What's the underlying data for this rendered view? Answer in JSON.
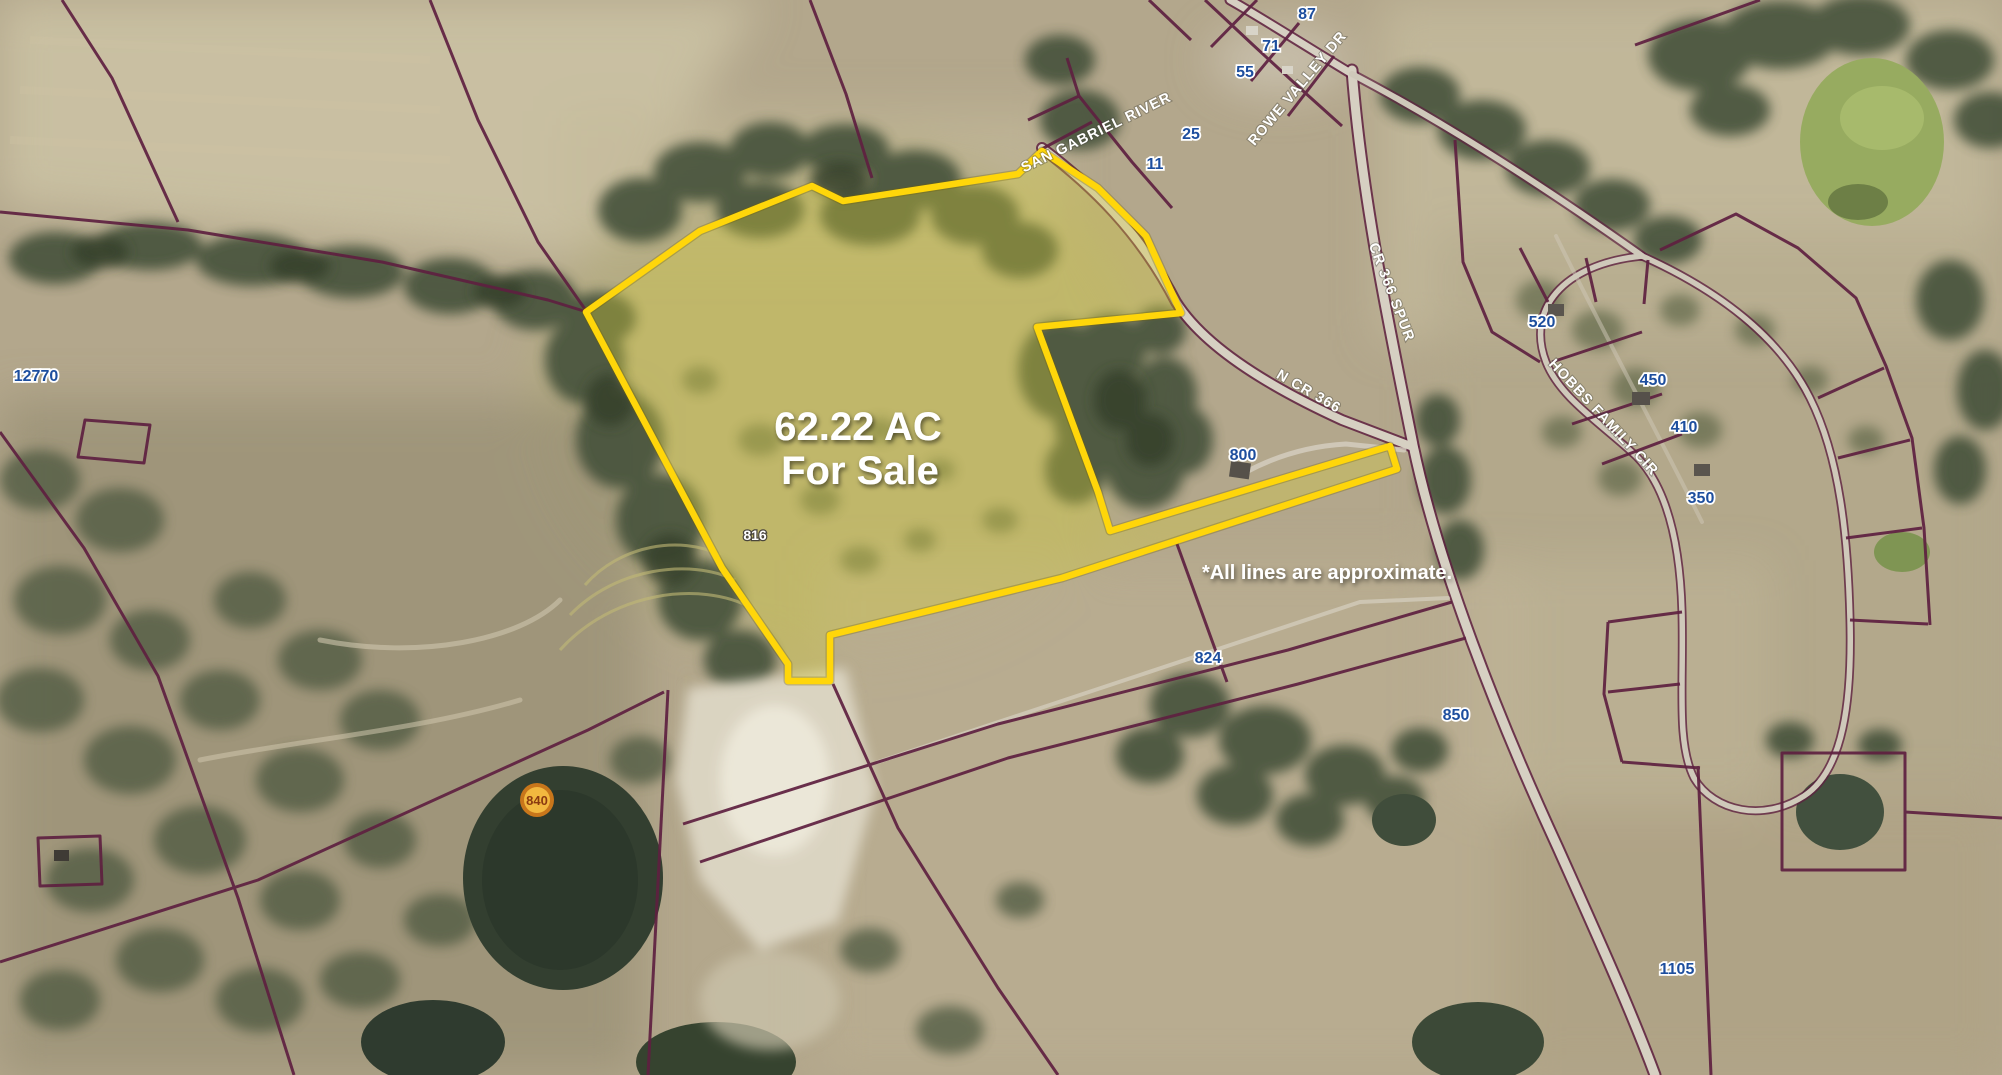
{
  "page": {
    "type": "aerial-property-listing-map"
  },
  "listing": {
    "acreage": "62.22 AC",
    "status": "For Sale",
    "disclaimer": "*All lines are approximate."
  },
  "marker": {
    "value": "840"
  },
  "roads": {
    "san_gabriel_river": "SAN GABRIEL RIVER",
    "rowe_valley_dr": "ROWE VALLEY DR",
    "cr_366_spur": "CR 366 SPUR",
    "n_cr_366": "N CR 366",
    "hobbs_family_cir": "HOBBS FAMILY CIR"
  },
  "addresses": {
    "a87": "87",
    "a71": "71",
    "a55": "55",
    "a25": "25",
    "a11": "11",
    "a12770": "12770",
    "a816": "816",
    "a800": "800",
    "a824": "824",
    "a850": "850",
    "a520": "520",
    "a450": "450",
    "a410": "410",
    "a350": "350",
    "a1105": "1105"
  },
  "colors": {
    "boundary_yellow": "#FFD60A",
    "parcel_fill_tint": "#D6CE3C",
    "parcel_line_maroon": "#5E2040",
    "address_blue": "#1D4E9E",
    "label_white": "#FFFFFF",
    "terrain_tan": "#B3A78C",
    "tree_green": "#45513A",
    "pond_dark": "#333F30",
    "pond_bright_green": "#97AB60",
    "marker_ring": "#C8761B",
    "marker_fill": "#F2B83F",
    "marker_text": "#8A3A10",
    "road_gray": "#D6D0C2"
  }
}
